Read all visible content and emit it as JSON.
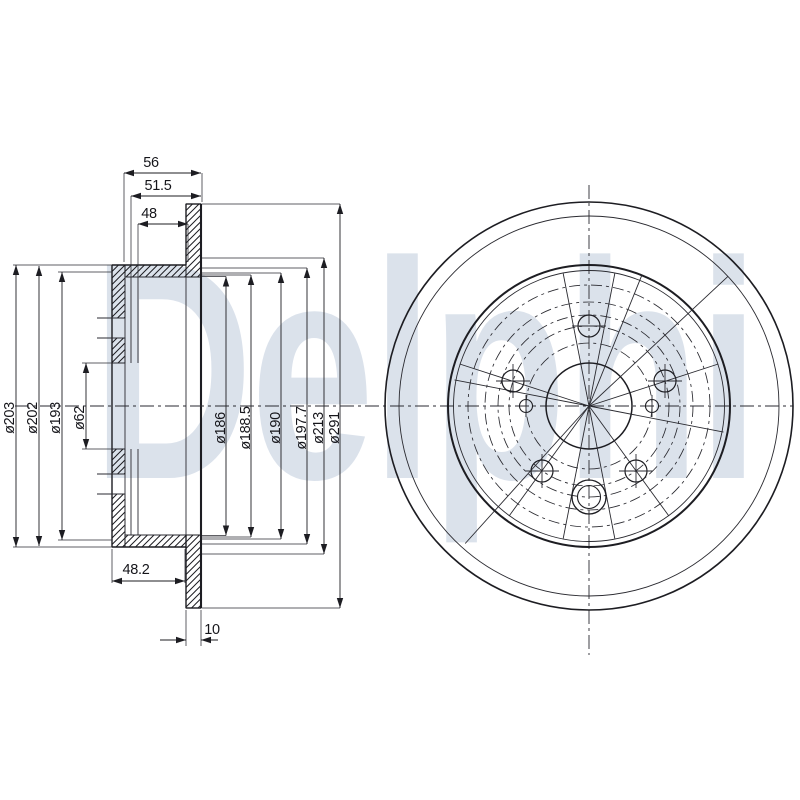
{
  "watermark": {
    "text": "Delphi",
    "color": "#b9c6d9"
  },
  "drawing": {
    "line_color": "#1d1d22",
    "background": "#ffffff",
    "description_labels": {
      "view_left": "section-view",
      "view_right": "front-view"
    }
  },
  "dims": {
    "w56": "56",
    "w51_5": "51.5",
    "w48": "48",
    "w48_2": "48.2",
    "w10": "10",
    "d203": "ø203",
    "d202": "ø202",
    "d193": "ø193",
    "d62": "ø62",
    "d186": "ø186",
    "d188_5": "ø188.5",
    "d190": "ø190",
    "d197_7": "ø197.7",
    "d213": "ø213",
    "d291": "ø291"
  }
}
